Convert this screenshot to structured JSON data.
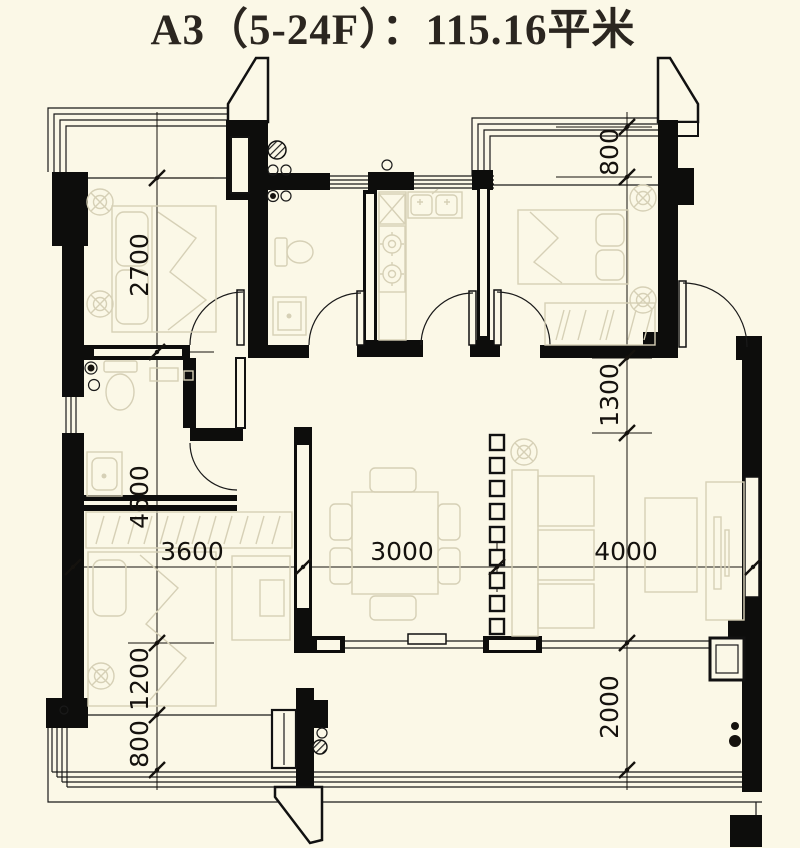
{
  "title": "A3（5-24F）：115.16平米",
  "unit": {
    "name": "A3",
    "floors": "5-24F",
    "area_sqm": "115.16",
    "area_label": "115.16平米"
  },
  "dimensions": {
    "left": {
      "d1": "2700",
      "d2": "4600",
      "d3": "1200",
      "d4": "800"
    },
    "right": {
      "d1": "800",
      "d2": "1300",
      "d3": "2000"
    },
    "bottom": {
      "d1": "3600",
      "d2": "3000",
      "d3": "4000"
    }
  },
  "colors": {
    "background": "#FBF8E7",
    "wall": "#0D0D0C",
    "line": "#1A1A1A",
    "furniture": "#D6D0B6",
    "title_text": "#2B2620"
  }
}
